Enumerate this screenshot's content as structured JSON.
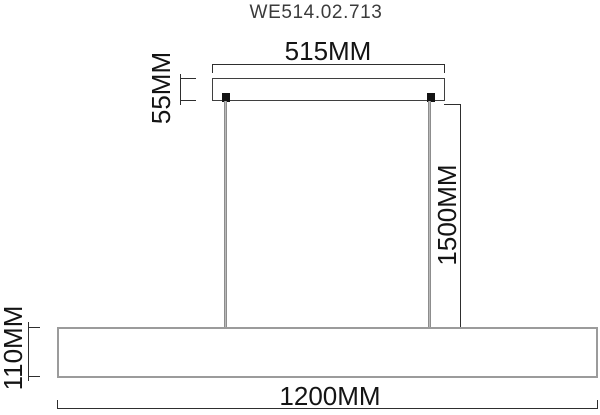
{
  "title": "WE514.02.713",
  "dims": {
    "canopy_width": "515MM",
    "canopy_height": "55MM",
    "drop_length": "1500MM",
    "bar_height": "110MM",
    "bar_width": "1200MM"
  },
  "colors": {
    "dim-line": "#2e2e2e",
    "dim-text": "#141414",
    "title-text": "#3b3b3b",
    "canopy-outline": "#3f3f3f",
    "bar-outline": "#9b9b9b",
    "wire": "#8b8b8b",
    "mount": "#141414",
    "background": "#ffffff"
  }
}
